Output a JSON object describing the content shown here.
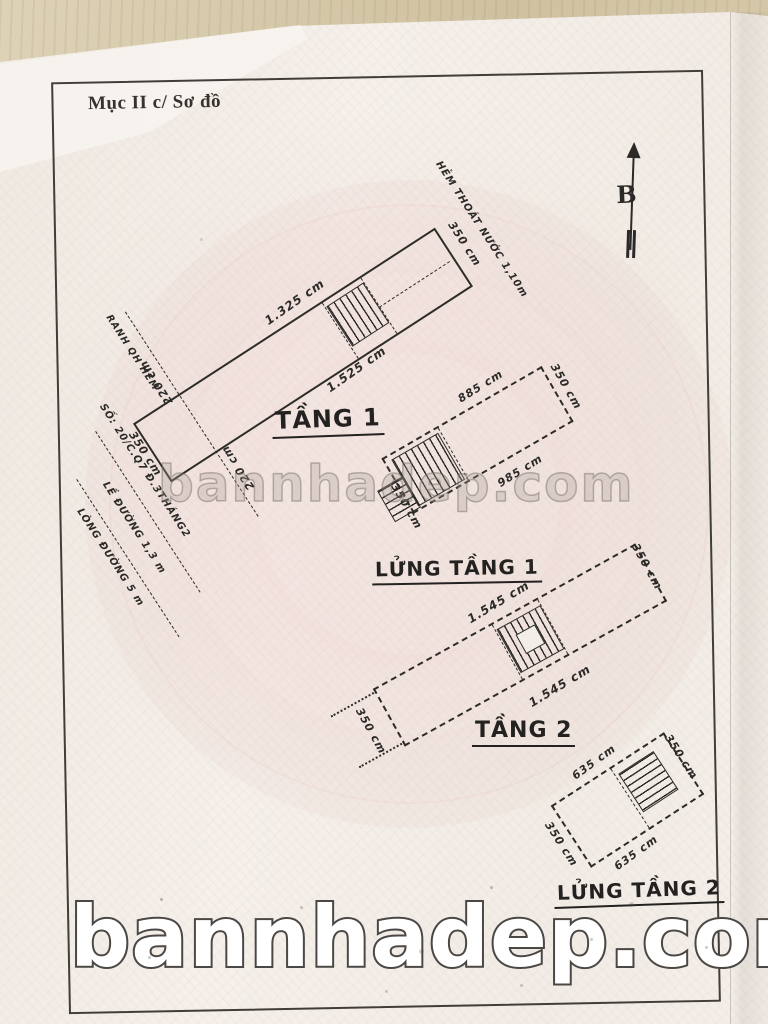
{
  "document": {
    "header": "Mục II c/ Sơ đồ",
    "compass_label": "B",
    "watermarks": {
      "center": "bannhadep.com",
      "bottom": "bannhadep.com"
    },
    "colors": {
      "paper": "#f3eee8",
      "wood": "#d7c9a9",
      "ink": "#2b2a28",
      "pink_pattern": "#eec9c9",
      "watermark_fill": "#ffffff",
      "watermark_outline": "#4a4744"
    },
    "plans": [
      {
        "name": "TẦNG 1",
        "dims": {
          "top": "1.325 cm",
          "bottom": "1.525 cm",
          "left": "350 cm",
          "right": "350 cm",
          "boundary_top": "220 cm",
          "boundary_bottom": "220 cm"
        },
        "annotations": {
          "boundary": "RANH QH HẺM",
          "alley": "HẺM THOÁT NƯỚC 1,10m",
          "address": "SỐ: 20/C.Q7 Đ.3THÁNG2",
          "sidewalk": "LỀ ĐƯỜNG 1,3 m",
          "road": "LÒNG ĐƯỜNG 5 m"
        }
      },
      {
        "name": "LỬNG TẦNG 1",
        "dims": {
          "top": "885 cm",
          "bottom": "985 cm",
          "left": "350 cm",
          "right": "350 cm"
        }
      },
      {
        "name": "TẦNG 2",
        "dims": {
          "top": "1.545 cm",
          "bottom": "1.545 cm",
          "left": "350 cm",
          "right": "350 cm"
        }
      },
      {
        "name": "LỬNG TẦNG 2",
        "dims": {
          "top": "635 cm",
          "bottom": "635 cm",
          "left": "350 cm",
          "right": "350 cm"
        }
      }
    ]
  }
}
